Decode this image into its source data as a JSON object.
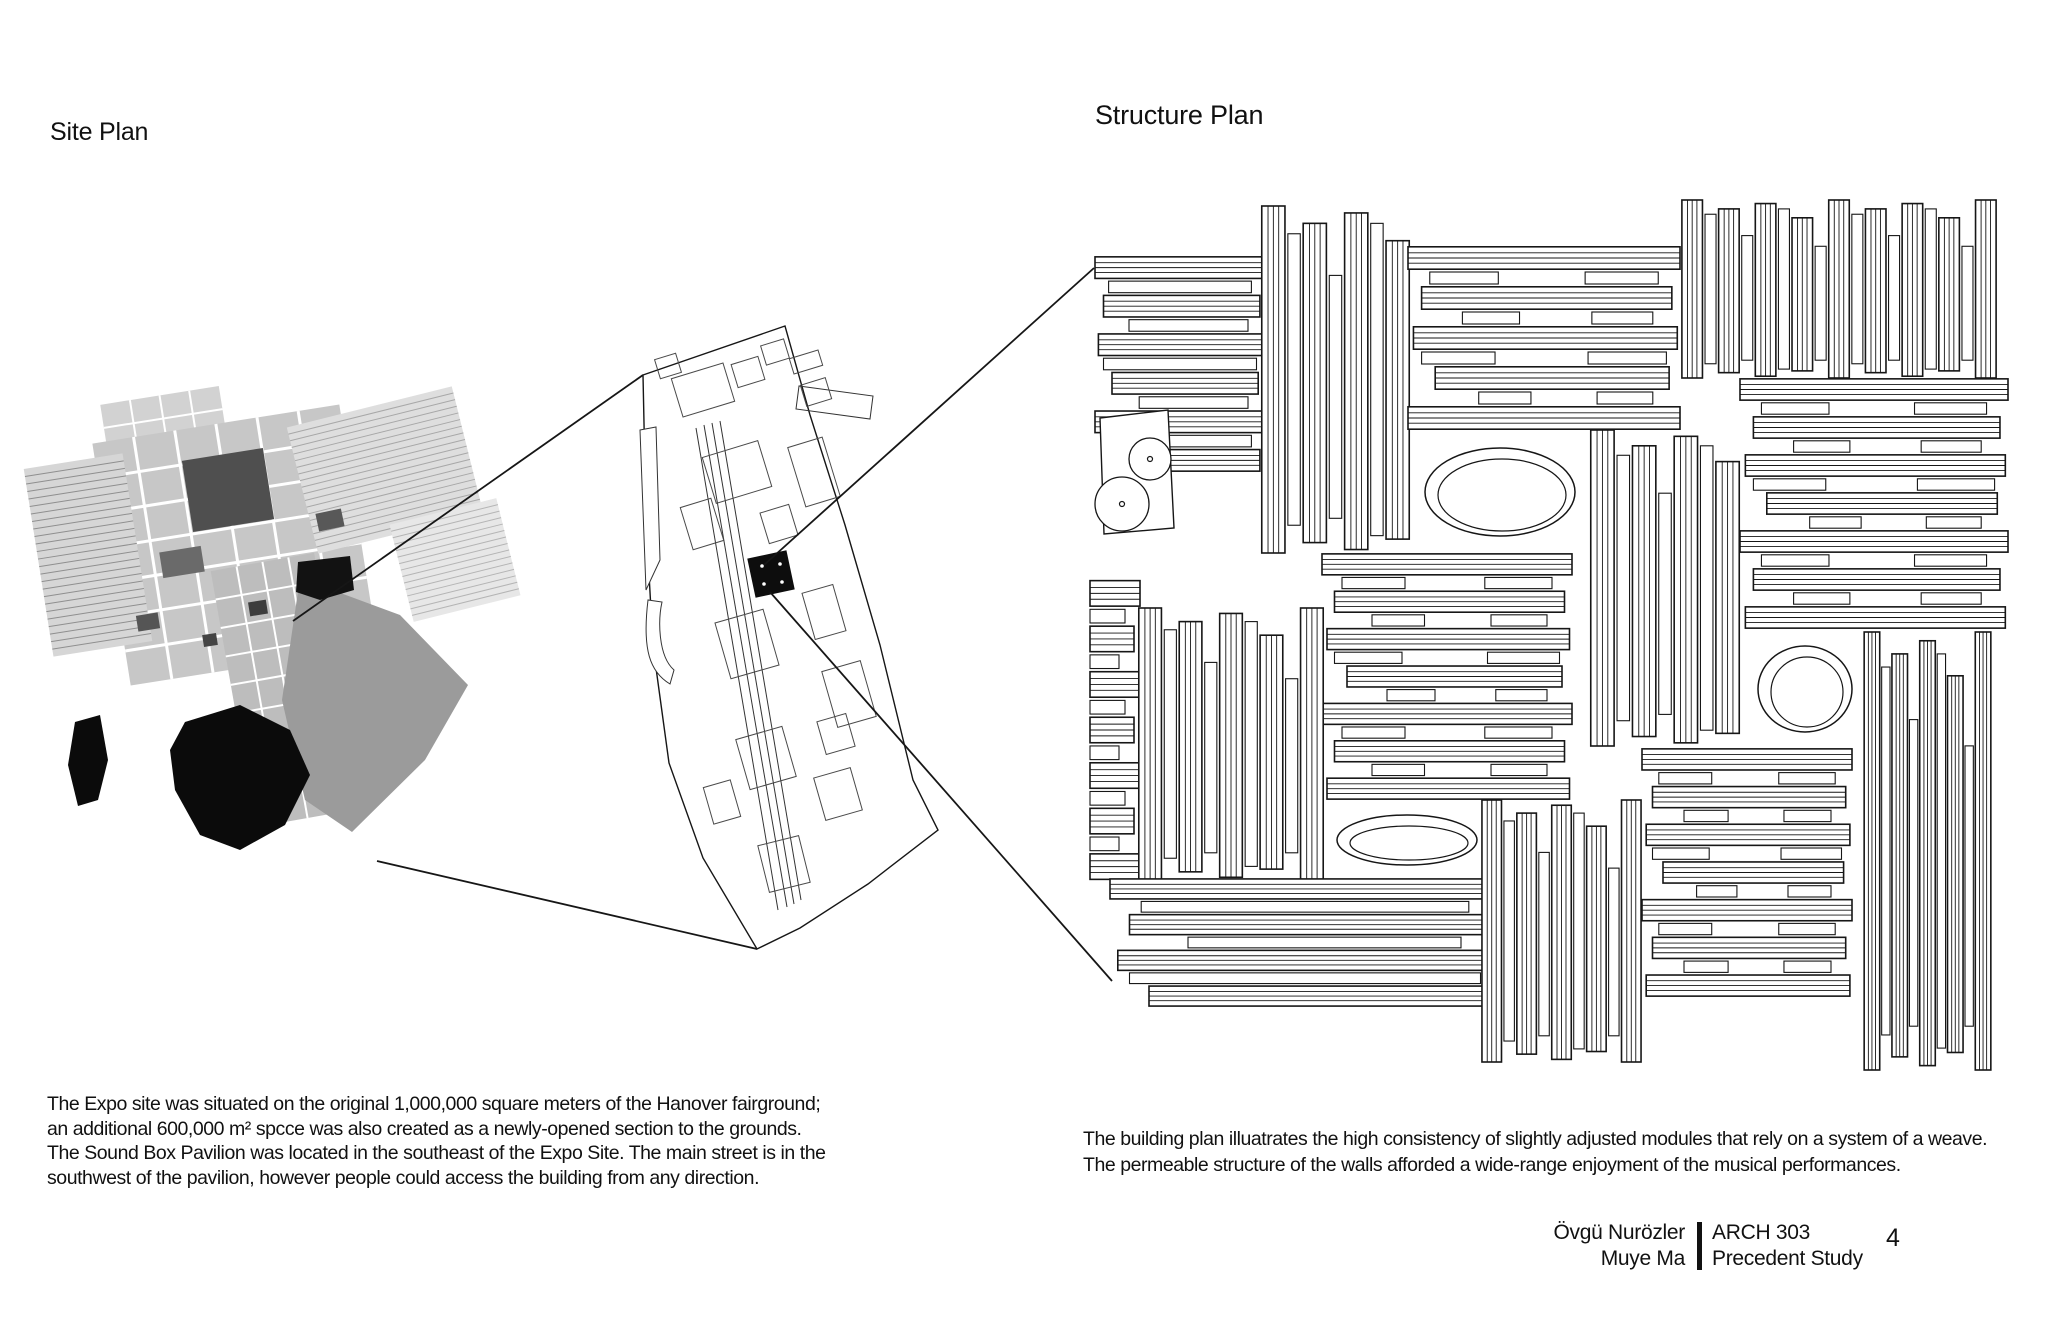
{
  "labels": {
    "site_plan": "Site Plan",
    "structure_plan": "Structure Plan"
  },
  "site_text": {
    "lines": [
      "The Expo site was situated on the original 1,000,000 square meters of the Hanover fairground;",
      "an additional 600,000 m² spcce was also created as a newly-opened section to the grounds.",
      "The Sound Box Pavilion was located in the southeast of the Expo Site.  The main street is in the",
      "southwest of the pavilion, however people could access the building from any direction."
    ]
  },
  "structure_text": {
    "lines": [
      "The building plan illuatrates the high consistency of slightly adjusted modules that rely on a system of a weave.",
      "The permeable structure of the walls afforded a wide-range enjoyment of the musical performances."
    ]
  },
  "credits": {
    "authors": [
      "Övgü Nurözler",
      "Muye Ma"
    ],
    "course": "ARCH 303",
    "project": "Precedent Study",
    "page_number": "4"
  },
  "colors": {
    "ink": "#161616",
    "outline_stroke": "#333333",
    "map_dark": "#4f4f4f",
    "map_mid": "#9b9b9b",
    "lake": "#0b0b0b",
    "background": "#ffffff"
  },
  "callout_lines": [
    [
      293,
      621,
      643,
      375
    ],
    [
      377,
      861,
      757,
      949
    ],
    [
      764,
      565,
      1094,
      268
    ],
    [
      770,
      592,
      1112,
      981
    ]
  ],
  "site_map": {
    "grids": [
      {
        "cx": 165,
        "cy": 430,
        "w": 120,
        "h": 70,
        "rot": -9,
        "fill": "#d2d2d2",
        "line": "#ffffff",
        "lw": 2,
        "nx": 3,
        "ny": 2
      },
      {
        "cx": 235,
        "cy": 545,
        "w": 250,
        "h": 245,
        "rot": -9,
        "fill": "#c7c7c7",
        "line": "#ffffff",
        "lw": 3,
        "nx": 5,
        "ny": 6
      },
      {
        "cx": 88,
        "cy": 555,
        "w": 100,
        "h": 190,
        "rot": -9,
        "fill": "#d6d6d6",
        "line": "#8f8f8f",
        "lw": 1,
        "nx": 0,
        "ny": 24
      },
      {
        "cx": 385,
        "cy": 470,
        "w": 170,
        "h": 130,
        "rot": -14,
        "fill": "#dedede",
        "line": "#a8a8a8",
        "lw": 1,
        "nx": 0,
        "ny": 18
      },
      {
        "cx": 455,
        "cy": 560,
        "w": 110,
        "h": 100,
        "rot": -14,
        "fill": "#e7e7e7",
        "line": "#b5b5b5",
        "lw": 1,
        "nx": 0,
        "ny": 14
      },
      {
        "cx": 285,
        "cy": 690,
        "w": 105,
        "h": 260,
        "rot": -10,
        "fill": "#bdbdbd",
        "line": "#ffffff",
        "lw": 2,
        "nx": 3,
        "ny": 8
      }
    ],
    "polys": [
      {
        "pts": "300,578 400,615 468,685 425,760 352,832 305,800 282,700",
        "fill": "#9b9b9b"
      },
      {
        "pts": "185,722 240,705 290,730 310,775 285,825 240,850 200,835 175,790 170,750",
        "fill": "#0b0b0b"
      },
      {
        "pts": "75,722 100,715 108,760 98,800 78,806 68,765",
        "fill": "#0b0b0b"
      },
      {
        "pts": "298,562 350,556 354,590 320,600 296,592",
        "fill": "#121212"
      }
    ],
    "rects": [
      {
        "cx": 228,
        "cy": 490,
        "w": 82,
        "h": 72,
        "rot": -9,
        "fill": "#4f4f4f"
      },
      {
        "cx": 182,
        "cy": 562,
        "w": 42,
        "h": 26,
        "rot": -9,
        "fill": "#6a6a6a"
      },
      {
        "cx": 330,
        "cy": 520,
        "w": 26,
        "h": 18,
        "rot": -12,
        "fill": "#585858"
      },
      {
        "cx": 258,
        "cy": 608,
        "w": 18,
        "h": 14,
        "rot": -9,
        "fill": "#3d3d3d"
      },
      {
        "cx": 148,
        "cy": 622,
        "w": 22,
        "h": 16,
        "rot": -9,
        "fill": "#555555"
      },
      {
        "cx": 210,
        "cy": 640,
        "w": 14,
        "h": 12,
        "rot": -9,
        "fill": "#444444"
      }
    ]
  },
  "outline_plan": {
    "boundary": "M643,375 L785,326 L810,415 L845,525 L880,645 L913,780 L938,830 L868,884 L800,928 L757,949 L703,858 L669,763 L653,646 L646,520 Z",
    "slivers": [
      "M640,430 L656,427 L660,560 L646,590 Z",
      "M648,600 C642,650 650,672 670,684 L674,670 C658,656 658,620 662,602 Z"
    ],
    "spine": [
      [
        696,
        428,
        778,
        910
      ],
      [
        704,
        425,
        787,
        907
      ],
      [
        712,
        423,
        794,
        904
      ],
      [
        720,
        421,
        801,
        900
      ]
    ],
    "crossbar": "M799,386 L873,396 L870,419 L796,409 Z",
    "parcels": [
      {
        "cx": 703,
        "cy": 390,
        "w": 54,
        "h": 40,
        "rot": -17
      },
      {
        "cx": 668,
        "cy": 366,
        "w": 22,
        "h": 20,
        "rot": -17
      },
      {
        "cx": 748,
        "cy": 372,
        "w": 28,
        "h": 24,
        "rot": -17
      },
      {
        "cx": 775,
        "cy": 352,
        "w": 24,
        "h": 20,
        "rot": -17
      },
      {
        "cx": 806,
        "cy": 362,
        "w": 30,
        "h": 16,
        "rot": -17
      },
      {
        "cx": 816,
        "cy": 392,
        "w": 26,
        "h": 22,
        "rot": -17
      },
      {
        "cx": 737,
        "cy": 472,
        "w": 58,
        "h": 48,
        "rot": -17
      },
      {
        "cx": 814,
        "cy": 472,
        "w": 36,
        "h": 62,
        "rot": -17
      },
      {
        "cx": 702,
        "cy": 524,
        "w": 32,
        "h": 44,
        "rot": -17
      },
      {
        "cx": 779,
        "cy": 524,
        "w": 30,
        "h": 32,
        "rot": -17
      },
      {
        "cx": 747,
        "cy": 644,
        "w": 50,
        "h": 58,
        "rot": -16
      },
      {
        "cx": 824,
        "cy": 612,
        "w": 32,
        "h": 48,
        "rot": -16
      },
      {
        "cx": 849,
        "cy": 694,
        "w": 40,
        "h": 58,
        "rot": -16
      },
      {
        "cx": 766,
        "cy": 758,
        "w": 48,
        "h": 52,
        "rot": -16
      },
      {
        "cx": 838,
        "cy": 794,
        "w": 38,
        "h": 44,
        "rot": -16
      },
      {
        "cx": 784,
        "cy": 864,
        "w": 42,
        "h": 48,
        "rot": -14
      },
      {
        "cx": 722,
        "cy": 802,
        "w": 28,
        "h": 38,
        "rot": -16
      },
      {
        "cx": 836,
        "cy": 734,
        "w": 30,
        "h": 34,
        "rot": -16
      }
    ],
    "black_square": {
      "cx": 771,
      "cy": 574,
      "w": 40,
      "h": 40,
      "rot": -12
    },
    "square_dots": [
      [
        762,
        566
      ],
      [
        780,
        564
      ],
      [
        764,
        584
      ],
      [
        782,
        582
      ]
    ]
  },
  "structure_plan": {
    "modules": [
      {
        "o": "h",
        "x": 1095,
        "y": 258,
        "w": 170,
        "h": 212,
        "n": 11
      },
      {
        "o": "v",
        "x": 1263,
        "y": 206,
        "w": 145,
        "h": 347,
        "n": 7
      },
      {
        "o": "h",
        "x": 1408,
        "y": 248,
        "w": 272,
        "h": 180,
        "n": 9,
        "split": true
      },
      {
        "o": "v",
        "x": 1683,
        "y": 200,
        "w": 312,
        "h": 178,
        "n": 17
      },
      {
        "o": "h",
        "x": 1740,
        "y": 380,
        "w": 268,
        "h": 247,
        "n": 13,
        "split": true
      },
      {
        "o": "v",
        "x": 1592,
        "y": 430,
        "w": 146,
        "h": 316,
        "n": 7
      },
      {
        "o": "h",
        "x": 1322,
        "y": 555,
        "w": 250,
        "h": 243,
        "n": 13,
        "split": true
      },
      {
        "o": "h",
        "x": 1090,
        "y": 582,
        "w": 50,
        "h": 296,
        "n": 13,
        "stub": true
      },
      {
        "o": "v",
        "x": 1140,
        "y": 608,
        "w": 182,
        "h": 272,
        "n": 9
      },
      {
        "o": "h",
        "x": 1110,
        "y": 880,
        "w": 390,
        "h": 125,
        "n": 7
      },
      {
        "o": "v",
        "x": 1483,
        "y": 800,
        "w": 157,
        "h": 262,
        "n": 9
      },
      {
        "o": "h",
        "x": 1642,
        "y": 750,
        "w": 210,
        "h": 245,
        "n": 13,
        "split": true
      },
      {
        "o": "v",
        "x": 1865,
        "y": 632,
        "w": 125,
        "h": 438,
        "n": 9
      }
    ],
    "ellipses": [
      {
        "cx": 1500,
        "cy": 492,
        "rx": 75,
        "ry": 44
      },
      {
        "cx": 1805,
        "cy": 689,
        "rx": 47,
        "ry": 43
      },
      {
        "cx": 1407,
        "cy": 840,
        "rx": 70,
        "ry": 25
      }
    ],
    "piano": {
      "quad": "M1100,418 L1168,410 L1174,528 L1104,534 Z",
      "circles": [
        {
          "cx": 1150,
          "cy": 459,
          "r": 21
        },
        {
          "cx": 1122,
          "cy": 504,
          "r": 27
        }
      ]
    }
  }
}
